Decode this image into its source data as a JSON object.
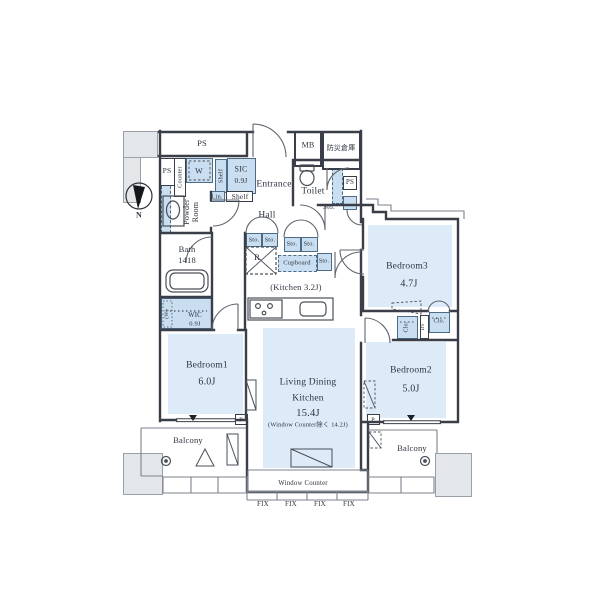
{
  "colors": {
    "room_fill": "#dcebf7",
    "storage_fill": "#c9def0",
    "wall": "#3a3e48",
    "gray_block": "#e3e7ea"
  },
  "compass": {
    "north": "N"
  },
  "utilities": {
    "ps_main": "PS",
    "ps_entry": "PS",
    "ps_toilet": "PS",
    "mb": "MB",
    "bousai": "防災倉庫",
    "ds": "DS",
    "pillar": "P"
  },
  "entry": {
    "entrance": "Entrance",
    "hall": "Hall",
    "sic_name": "SIC",
    "sic_size": "0.9J",
    "shelf_vertical": "Shelf",
    "shelf_lower": "Shelf",
    "linen": "Lin.",
    "counter": "Counter",
    "washer": "W"
  },
  "sanitary": {
    "toilet": "Toilet",
    "powder_line1": "Powder",
    "powder_line2": "Room",
    "bath_name": "Bath",
    "bath_size": "1418",
    "toilet_storage": "Sto."
  },
  "kitchen": {
    "label": "(Kitchen 3.2J)",
    "fridge": "R",
    "cupboard": "Cupboard",
    "storage": [
      "Sto.",
      "Sto.",
      "Sto.",
      "Sto."
    ],
    "storage_small": "Sto."
  },
  "rooms": {
    "ldk": {
      "line1": "Living Dining",
      "line2": "Kitchen",
      "size": "15.4J",
      "note": "(Window Counter除く 14.2J)"
    },
    "bedroom1": {
      "name": "Bedroom1",
      "size": "6.0J"
    },
    "bedroom2": {
      "name": "Bedroom2",
      "size": "5.0J"
    },
    "bedroom3": {
      "name": "Bedroom3",
      "size": "4.7J"
    },
    "wic": {
      "name": "WIC",
      "size": "0.9J",
      "side_note": "(W)"
    }
  },
  "closets": {
    "left": "Clo.",
    "right": "Clo."
  },
  "outdoor": {
    "balcony_left": "Balcony",
    "balcony_right": "Balcony",
    "window_counter": "Window Counter",
    "fix_windows": [
      "FIX",
      "FIX",
      "FIX",
      "FIX"
    ]
  }
}
